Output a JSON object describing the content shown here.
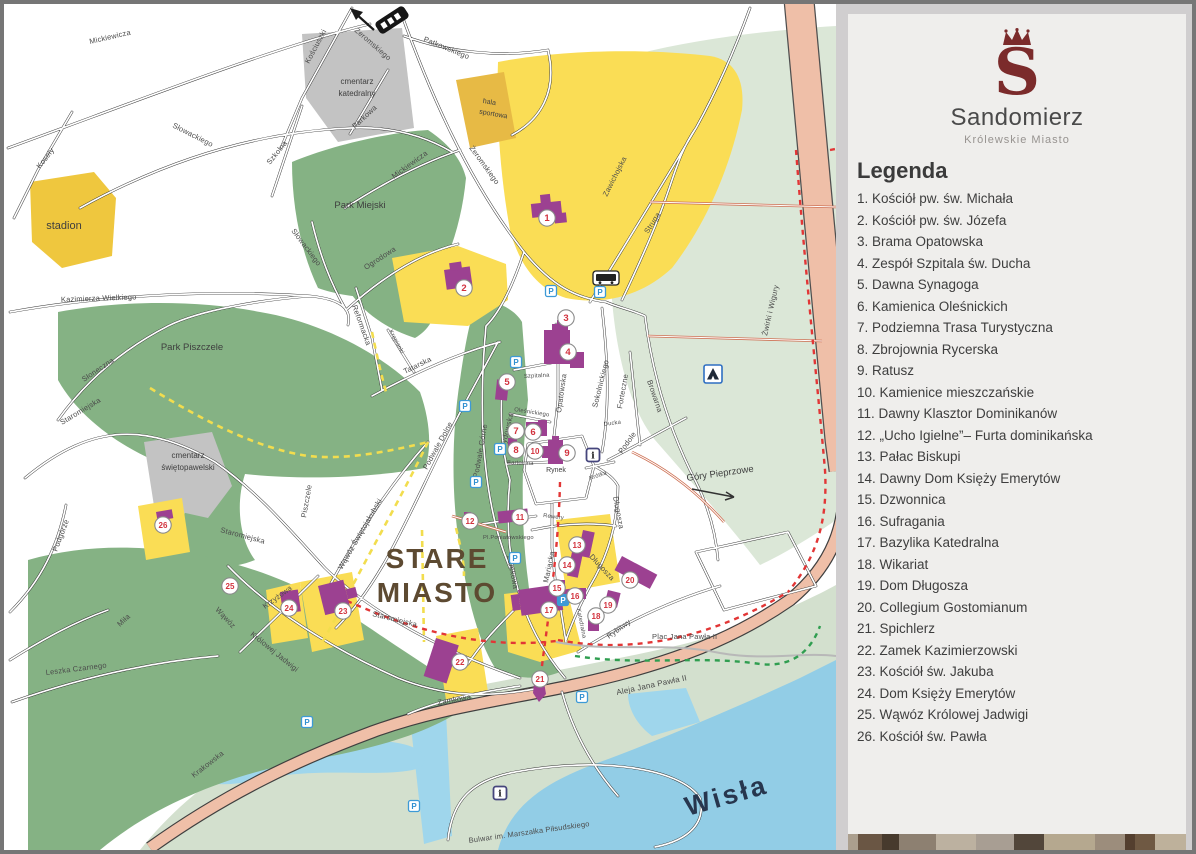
{
  "panel": {
    "logo_letter": "S",
    "title": "Sandomierz",
    "subtitle": "Królewskie Miasto",
    "legend_title": "Legenda",
    "items": [
      "1. Kościół pw. św. Michała",
      "2. Kościół pw. św. Józefa",
      "3. Brama Opatowska",
      "4. Zespół Szpitala św. Ducha",
      "5. Dawna Synagoga",
      "6. Kamienica Oleśnickich",
      "7. Podziemna Trasa Turystyczna",
      "8. Zbrojownia Rycerska",
      "9. Ratusz",
      "10. Kamienice mieszczańskie",
      "11. Dawny Klasztor Dominikanów",
      "12. „Ucho Igielne”– Furta dominikańska",
      "13. Pałac Biskupi",
      "14. Dawny Dom Księży Emerytów",
      "15. Dzwonnica",
      "16. Sufragania",
      "17. Bazylika Katedralna",
      "18. Wikariat",
      "19. Dom Długosza",
      "20. Collegium Gostomianum",
      "21. Spichlerz",
      "22. Zamek Kazimierzowski",
      "23. Kościół św. Jakuba",
      "24. Dom Księży Emerytów",
      "25. Wąwóz Królowej Jadwigi",
      "26. Kościół św. Pawła"
    ]
  },
  "map": {
    "streets": [
      "Mickiewicza",
      "Kościuszki",
      "Żeromskiego",
      "Patkowskiego",
      "Parkowa",
      "Słowackiego",
      "Szkolna",
      "Mickiewicza",
      "Słowackiego",
      "Ogrodowa",
      "Koseły",
      "Kazimierza Wielkiego",
      "Słoneczna",
      "Staromiejska",
      "Zawichojska",
      "Struga",
      "Żwirki i Wigury",
      "Żeromskiego",
      "Reformacka",
      "Krępianki",
      "Tatarska",
      "Podwale Dolne",
      "Podwale Górne",
      "Żydowska",
      "Opatowska",
      "Szpitalna",
      "Oleśnickiego",
      "Bartolona",
      "Sokolnickiego",
      "Forteczne",
      "Browarna",
      "Podole",
      "Ducka",
      "Krótka",
      "Rewery",
      "Zamkowa",
      "Mariacka",
      "Długosza",
      "Długosza",
      "Katedralna",
      "Rybitwy",
      "Piszczele",
      "Wąwóz Świętojakubski",
      "Staromiejska",
      "Staromiejska",
      "Krzyżowa",
      "Wąwóz",
      "Królowej Jadwigi",
      "Podgórze",
      "Miła",
      "Leszka Czarnego",
      "Krakowska",
      "Zamkowa"
    ],
    "labels": {
      "stadion": "stadion",
      "hala_1": "hala",
      "hala_2": "sportowa",
      "cm_kat_1": "cmentarz",
      "cm_kat_2": "katedralny",
      "cm_sw_1": "cmentarz",
      "cm_sw_2": "świętopawelski",
      "park_miejski": "Park Miejski",
      "park_piszczele": "Park Piszczele",
      "stare_1": "STARE",
      "stare_2": "MIASTO",
      "rynek": "Rynek",
      "pl_poniatowskiego": "Pl.Poniatowskiego",
      "plac_jp2": "Plac Jana Pawła II",
      "aleja_jp2": "Aleja Jana Pawła II",
      "bulwar": "Bulwar im. Marszałka Piłsudskiego",
      "gory_pieprzowe": "Góry Pieprzowe",
      "wisla": "Wisła"
    },
    "markers": [
      "1",
      "2",
      "3",
      "4",
      "5",
      "6",
      "7",
      "8",
      "9",
      "10",
      "11",
      "12",
      "13",
      "14",
      "15",
      "16",
      "17",
      "18",
      "19",
      "20",
      "21",
      "22",
      "23",
      "24",
      "25",
      "26"
    ],
    "icons": {
      "parking": "P",
      "info": "i"
    }
  },
  "colors": {
    "brand_maroon": "#7b2b2b",
    "marker_number": "#d2333e",
    "water_blue": "#92cde6",
    "park_green": "#85b284",
    "pale_green": "#d9e5d5",
    "road_salmon": "#efbfa8",
    "building_purple": "#9c4191",
    "block_yellow": "#fadd55",
    "trail_red": "#e23636",
    "trail_yellow": "#f2dd4e",
    "trail_green": "#2f9e50",
    "parking_blue": "#3d9ad6",
    "footer_strip": [
      "#ab9f8e",
      "#6a5644",
      "#473a2d",
      "#8d8071",
      "#bcb1a0",
      "#a89e93",
      "#52463a",
      "#b5a88f",
      "#9c8d7c",
      "#543f2f",
      "#6f5943",
      "#beb19b"
    ]
  }
}
